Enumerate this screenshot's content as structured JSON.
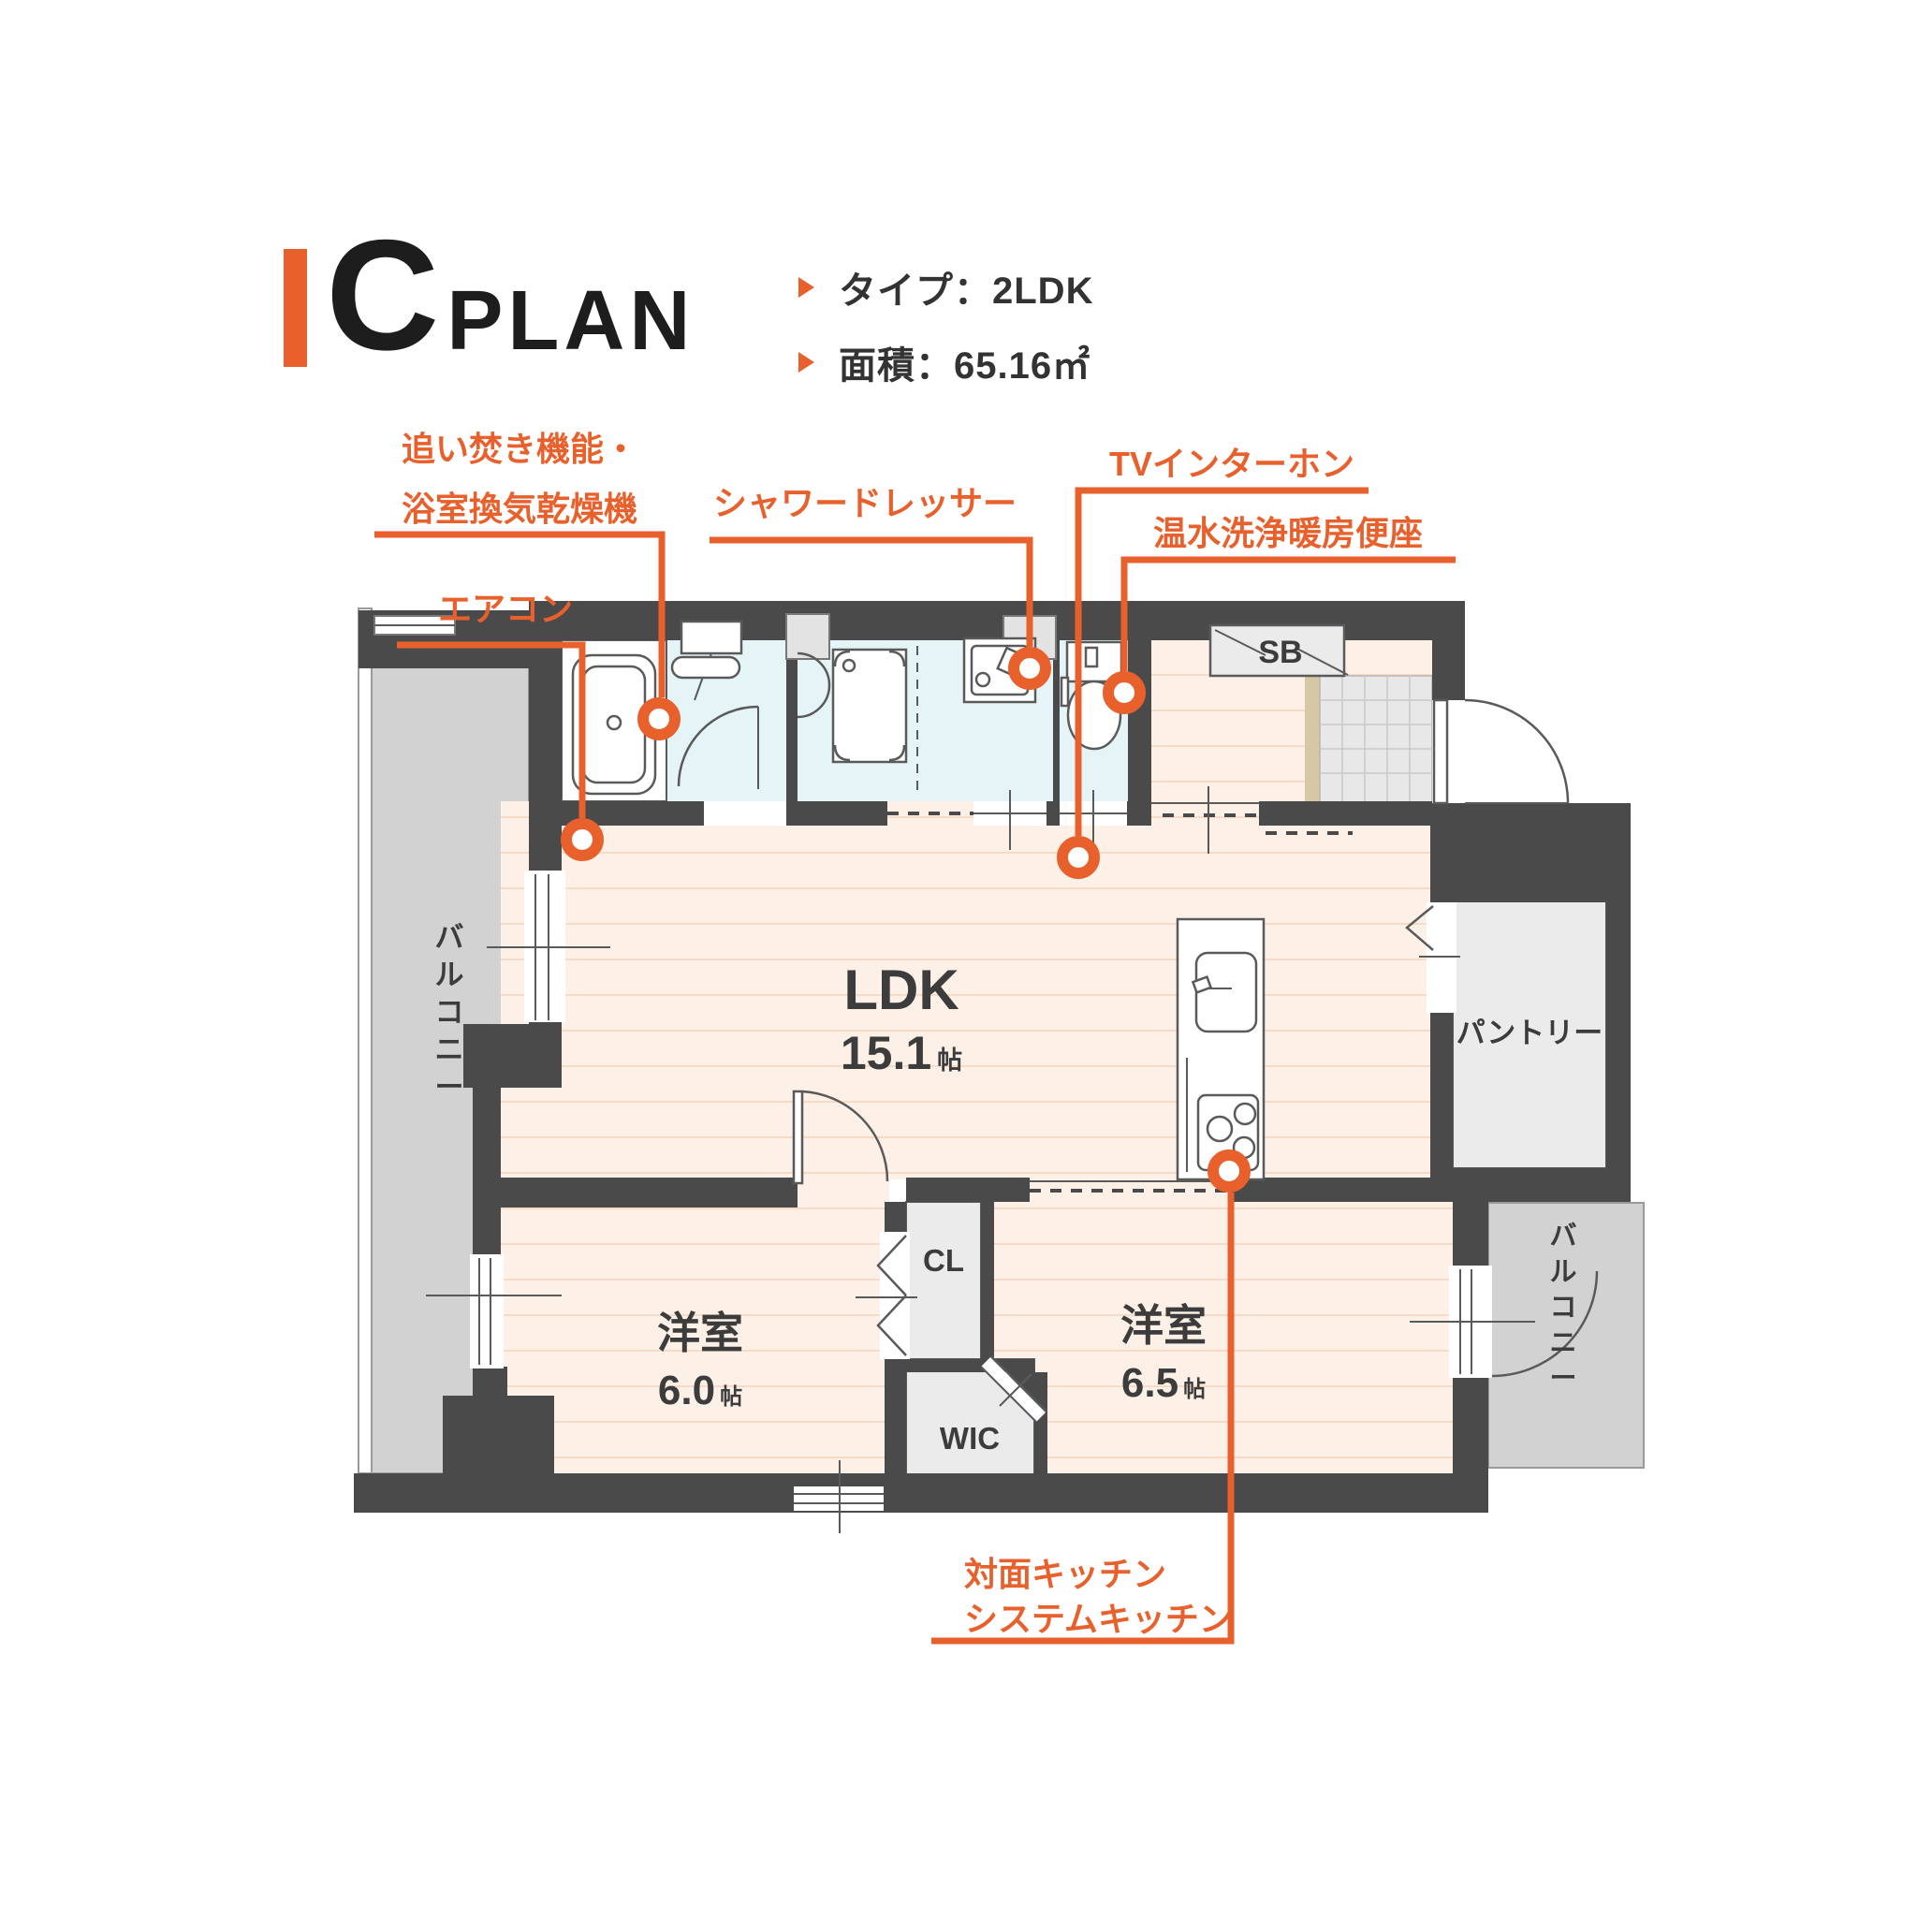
{
  "header": {
    "plan_letter": "C",
    "plan_word": "PLAN",
    "specs": [
      {
        "text": "タイプ：2LDK"
      },
      {
        "text": "面積：65.16㎡"
      }
    ]
  },
  "callouts": {
    "bath_reheat": {
      "line1": "追い焚き機能・",
      "line2": "浴室換気乾燥機"
    },
    "aircon": {
      "text": "エアコン"
    },
    "shower_dresser": {
      "text": "シャワードレッサー"
    },
    "tv_intercom": {
      "text": "TVインターホン"
    },
    "washlet": {
      "text": "温水洗浄暖房便座"
    },
    "kitchen": {
      "line1": "対面キッチン",
      "line2": "システムキッチン"
    }
  },
  "rooms": {
    "ldk": {
      "name": "LDK",
      "size": "15.1",
      "unit": "帖"
    },
    "bedroom_west": {
      "name": "洋室",
      "size": "6.0",
      "unit": "帖"
    },
    "bedroom_east": {
      "name": "洋室",
      "size": "6.5",
      "unit": "帖"
    },
    "closet": {
      "name": "CL"
    },
    "wic": {
      "name": "WIC"
    },
    "pantry": {
      "name": "パントリー"
    },
    "shoe_box": {
      "name": "SB"
    },
    "balcony_left": {
      "name": "バルコニー"
    },
    "balcony_right": {
      "name": "バルコニー"
    }
  },
  "colors": {
    "accent": "#E8612C",
    "wall": "#4A4A4A",
    "floor": "#FDF0E7",
    "floor_stripe": "#F5DBC8",
    "wet_area": "#E4F4F7",
    "balcony": "#D2D2D2",
    "storage": "#EBEBEB",
    "entrance_tile": "#E8E8E8",
    "step": "#D8C7A4",
    "text": "#333333"
  }
}
